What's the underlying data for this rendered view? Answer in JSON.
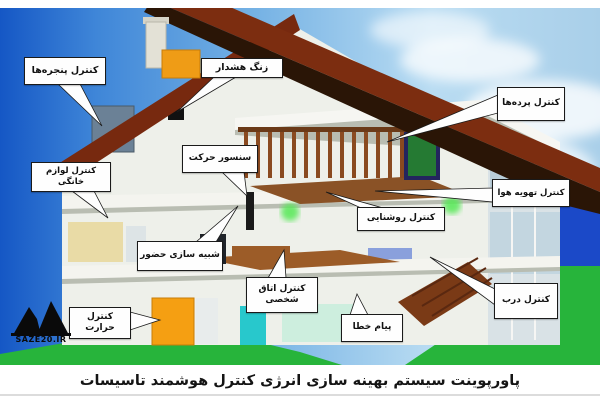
{
  "caption": "پاورپوینت سیستم بهینه سازی انرژی کنترل هوشمند تاسیسات",
  "watermark": {
    "text": "Saze20.ir"
  },
  "labels": [
    {
      "id": "window-control",
      "text": "کنترل پنجره‌ها"
    },
    {
      "id": "alarm-bell",
      "text": "زنگ هشدار"
    },
    {
      "id": "curtains-control",
      "text": "کنترل پرده‌ها"
    },
    {
      "id": "appliances-control",
      "text": "کنترل لوازم خانگی"
    },
    {
      "id": "motion-sensor",
      "text": "سنسور حرکت"
    },
    {
      "id": "ventilation-control",
      "text": "کنترل تهویه هوا"
    },
    {
      "id": "presence-simulation",
      "text": "شبیه سازی حضور"
    },
    {
      "id": "lighting-control",
      "text": "کنترل روشنایی"
    },
    {
      "id": "personal-room-control",
      "text": "کنترل اتاق شخصی"
    },
    {
      "id": "door-control",
      "text": "کنترل درب"
    },
    {
      "id": "error-message",
      "text": "پیام خطا"
    },
    {
      "id": "temperature-control",
      "text": "کنترل حرارت"
    }
  ],
  "colors": {
    "sky_deep_blue": "#1557c5",
    "sky_light": "#b9dcf2",
    "grass_green": "#27b43b",
    "field_blue": "#1b49c8",
    "roof_dark_brown": "#2a1506",
    "roof_tile_red": "#7c2d10",
    "house_white": "#eef0ea",
    "callout_bg": "#fefefe",
    "callout_border": "#1a1a1a",
    "accent_orange": "#f59f12"
  }
}
